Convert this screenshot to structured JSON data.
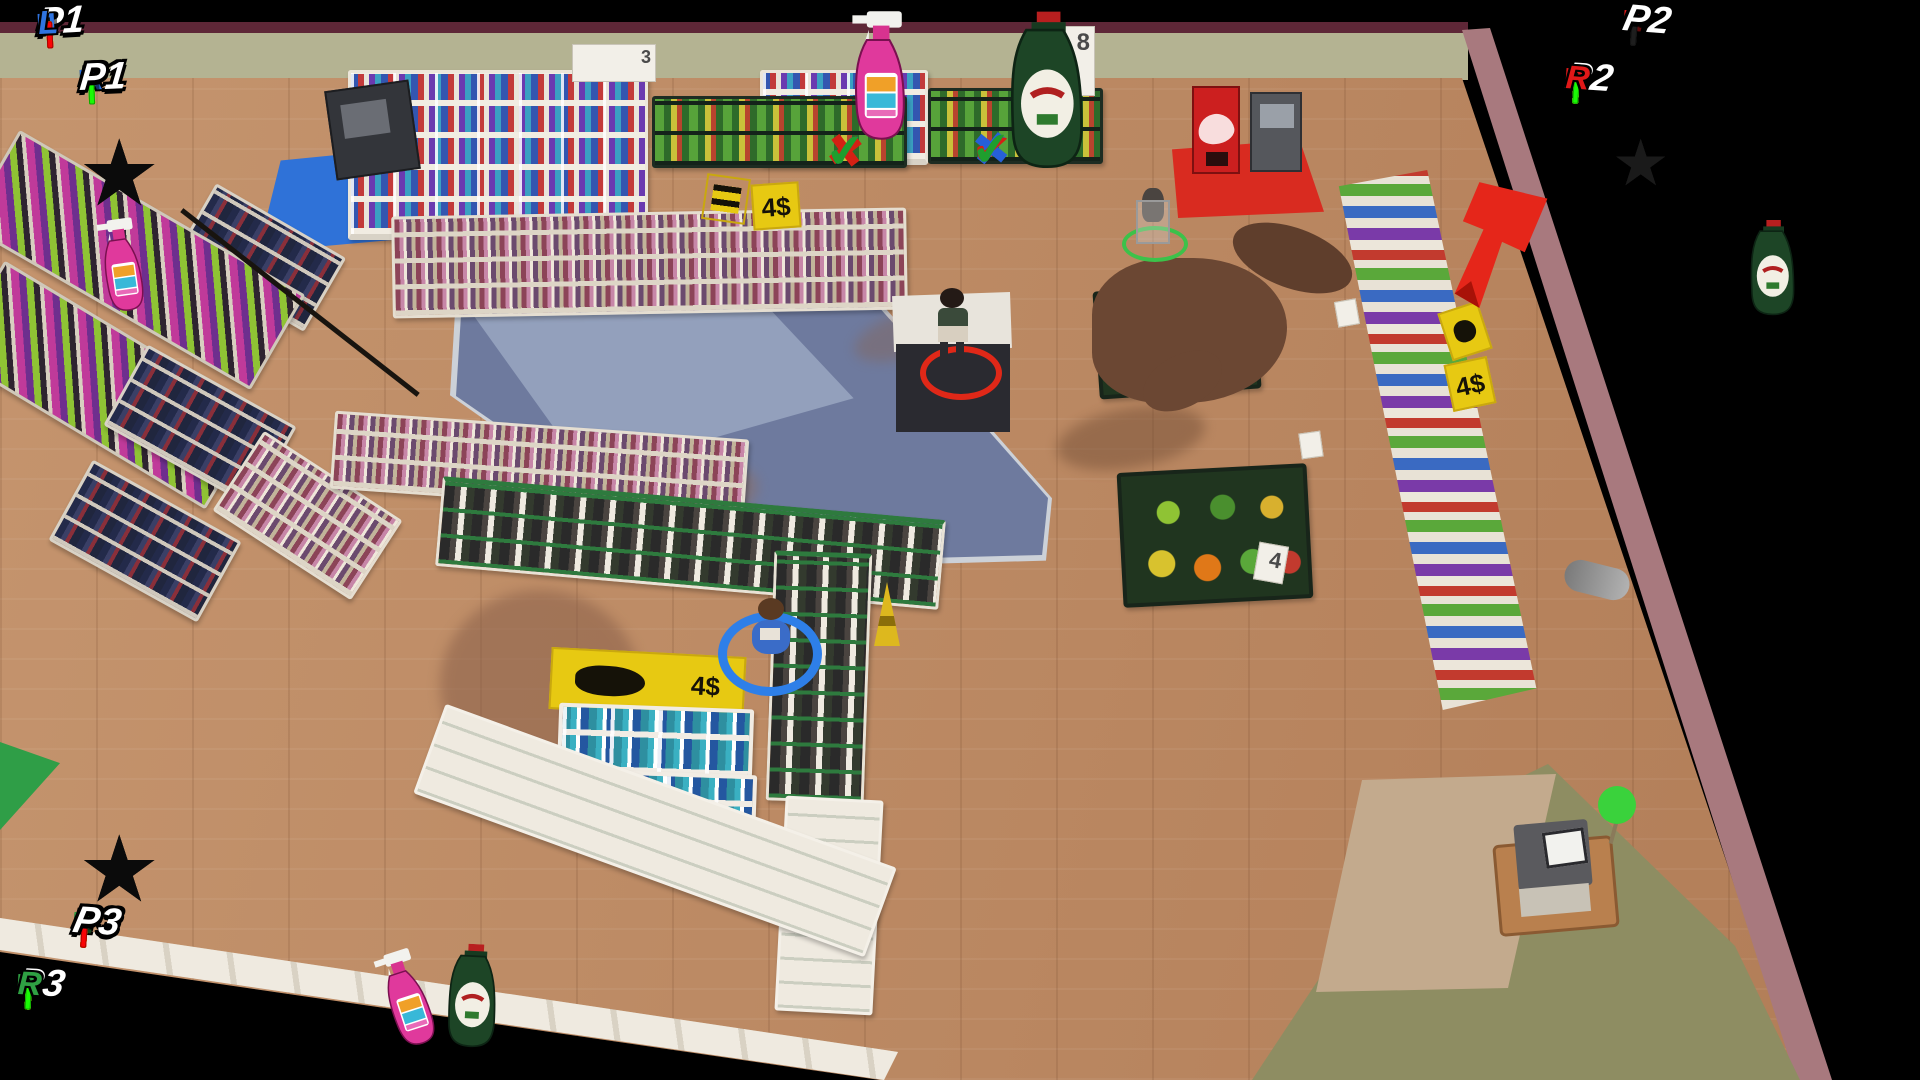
{
  "game": {
    "scene": "supermarket-level"
  },
  "hud": {
    "p1": {
      "label": "P1",
      "left_bar_label": "L",
      "right_bar_label": "R",
      "stars": 3,
      "accent": "#2f74e0",
      "star_color": "#0b0b0b",
      "bars": {
        "left": {
          "segments": 20,
          "filled": 20,
          "direction": "green-to-red"
        },
        "right": {
          "segments": 20,
          "filled": 20,
          "direction": "red-to-green"
        }
      }
    },
    "p2": {
      "label": "P2",
      "left_bar_label": "L",
      "right_bar_label": "R",
      "stars": 3,
      "accent": "#e01818",
      "star_color": "#1a1a1a",
      "bars": {
        "left": {
          "segments": 20,
          "filled": 0,
          "direction": "green-to-red"
        },
        "right": {
          "segments": 20,
          "filled": 20,
          "direction": "red-to-green"
        }
      }
    },
    "p3": {
      "label": "P3",
      "left_bar_label": "L",
      "right_bar_label": "R",
      "stars": 3,
      "accent": "#2fa043",
      "star_color": "#0b0b0b",
      "bars": {
        "left": {
          "segments": 20,
          "filled": 20,
          "direction": "green-to-red"
        },
        "right": {
          "segments": 20,
          "filled": 20,
          "direction": "red-to-green"
        }
      }
    }
  },
  "objectives": {
    "items": [
      {
        "name": "pink-spray-bottle",
        "marks": [
          {
            "glyph": "✔",
            "color": "#2660d8"
          },
          {
            "glyph": "✖",
            "color": "#d42114"
          },
          {
            "glyph": "✔",
            "color": "#1f9e2e"
          }
        ]
      },
      {
        "name": "green-detergent-bottle",
        "marks": [
          {
            "glyph": "✖",
            "color": "#2660d8"
          },
          {
            "glyph": "✔",
            "color": "#d42114"
          },
          {
            "glyph": "✔",
            "color": "#1f9e2e"
          }
        ]
      }
    ]
  },
  "signs": {
    "top_small": "3",
    "top_right_price": "8",
    "discount_tag": "-12",
    "aisle_promo": "4$",
    "wall_promo": "4$",
    "pallet_promo": "4$",
    "produce_price": "4"
  },
  "markers": {
    "arrow_color": "#e5261a",
    "target_item": "green-detergent-bottle"
  }
}
